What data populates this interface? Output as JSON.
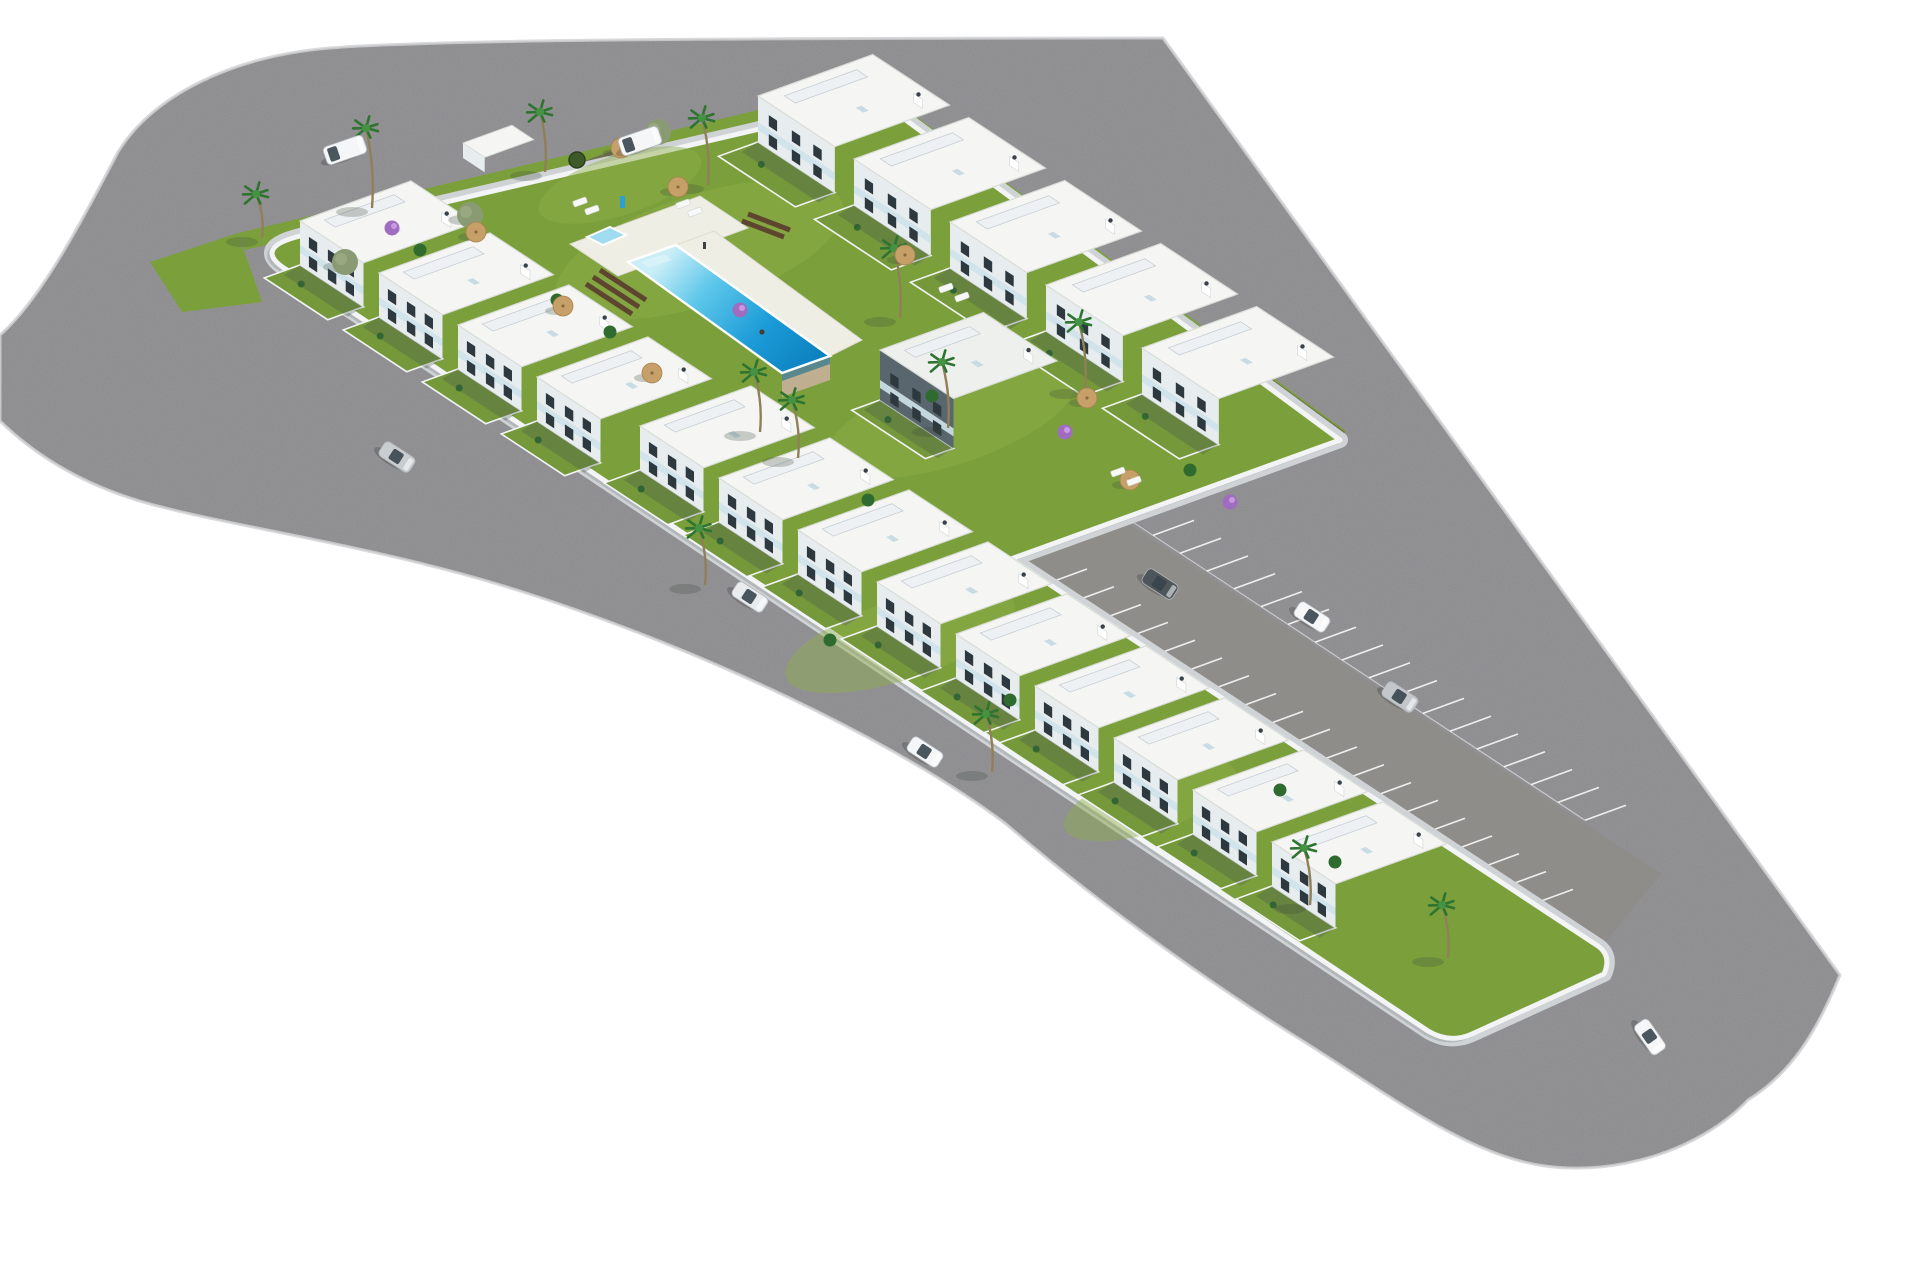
{
  "scene": {
    "width": 1920,
    "height": 1280,
    "background": "#ffffff",
    "label": "Aerial 3D architectural render of an L-shaped residential development: rows of white two-storey townhouses with roof terraces and external stairs, central communal garden with long turquoise pool, perimeter roads, parking bays and scattered cars, palms and parasols"
  },
  "axes": {
    "a": [
      0.94,
      -0.34
    ],
    "b": [
      0.835,
      0.55
    ]
  },
  "colors": {
    "asphalt": "#9e9ea1",
    "pave": "#8f8d8a",
    "curb": "#cfd3d6",
    "wall": "#f2f4f5",
    "wallShadow": "rgba(90,100,105,0.25)",
    "grass": "#7ba03b",
    "grassLight": "#8fae4a",
    "gardenGrass": "#74983a",
    "deck": "#efeee5",
    "water0": "#c9eef7",
    "water1": "#5ec7ea",
    "water2": "#1b9bd7",
    "water3": "#0c7fbe",
    "kidPool": "#9fdcef",
    "stone": "#bfae90",
    "overflow": "#46808e",
    "wood": "#5d4530",
    "roof": "#f5f6f3",
    "roofEdge": "#d9ddd8",
    "wallFace": "#e7ecef",
    "window": "#2e383f",
    "glass": "#cfe3ea",
    "stair": "#eef1f3",
    "slate": "#5a666e",
    "slateRoof": "#eef0ee",
    "bamboo": "#6e6e50",
    "palmFrond": "#2f7330",
    "palmFrond2": "#459243",
    "trunk": "#917f58",
    "olive": "#8a9b74",
    "bush": "#2f6b2e",
    "flower": "#a06cc0",
    "umbrella": "#c7a069",
    "lounger": "#f7f8f8",
    "parkLine": "rgba(255,255,255,0.85)",
    "shadow": "rgba(70,80,78,0.28)",
    "treeShadow": "rgba(60,72,60,0.25)",
    "carGlass": "#39454d"
  },
  "road": {
    "outline": "M 0,335 C 40,300 78,228 118,152 C 152,96 232,56 330,48 C 430,40 700,38 1163,38 L 1840,975 C 1816,1034 1790,1074 1748,1100 C 1700,1150 1618,1176 1545,1166 C 1468,1156 1388,1094 1298,1038 C 1192,972 1080,888 1006,824 C 898,742 700,648 520,591 C 378,546 238,528 150,504 C 88,487 38,458 0,421 Z"
  },
  "island": {
    "outline": "M 880,101 L 1340,440 L 1011,559 L 1598,946 Q 1612,956 1604,974 L 1472,1034 Q 1450,1044 1428,1031 L 300,277 Q 244,250 300,236 Z"
  },
  "verges": [
    {
      "pts": [
        [
          245,
          250
        ],
        [
          875,
          100
        ],
        [
          868,
          84
        ],
        [
          238,
          233
        ]
      ]
    },
    {
      "pts": [
        [
          150,
          262
        ],
        [
          238,
          233
        ],
        [
          262,
          302
        ],
        [
          182,
          312
        ]
      ]
    },
    {
      "pts": [
        [
          875,
          100
        ],
        [
          1340,
          440
        ],
        [
          1346,
          431
        ],
        [
          881,
          91
        ]
      ]
    }
  ],
  "bamboo": [
    {
      "pts": [
        [
          480,
          207
        ],
        [
          643,
          146
        ],
        [
          646,
          138
        ],
        [
          483,
          199
        ]
      ]
    },
    {
      "pts": [
        [
          1128,
          286
        ],
        [
          1340,
          440
        ],
        [
          1345,
          432
        ],
        [
          1133,
          278
        ]
      ]
    },
    {
      "pts": [
        [
          780,
          132
        ],
        [
          870,
          98
        ],
        [
          872,
          92
        ],
        [
          782,
          126
        ]
      ]
    }
  ],
  "parking": {
    "pave": [
      [
        1035,
        462
      ],
      [
        1661,
        874
      ],
      [
        1601,
        948
      ],
      [
        1014,
        560
      ]
    ],
    "rows": [
      {
        "start": [
          1072,
          482
        ],
        "step": [
          27,
          17.8
        ],
        "count": 20,
        "tick": [
          41,
          -15
        ]
      },
      {
        "start": [
          1046,
          584
        ],
        "step": [
          27,
          17.8
        ],
        "count": 19,
        "tick": [
          41,
          -15
        ]
      }
    ]
  },
  "lawnPatches": [
    {
      "c": [
        700,
        250
      ],
      "rx": 150,
      "ry": 55
    },
    {
      "c": [
        950,
        420
      ],
      "rx": 130,
      "ry": 45
    },
    {
      "c": [
        620,
        185
      ],
      "rx": 85,
      "ry": 30
    },
    {
      "c": [
        900,
        640
      ],
      "rx": 120,
      "ry": 40
    },
    {
      "c": [
        1150,
        800
      ],
      "rx": 90,
      "ry": 32
    }
  ],
  "rows": [
    {
      "name": "row-upper-right",
      "anchor": [
        758,
        142
      ],
      "step": [
        96,
        63
      ],
      "count": 5,
      "w": 92,
      "d": 122,
      "h": 46,
      "garden": 42
    },
    {
      "name": "building-special",
      "anchor": [
        880,
        400
      ],
      "step": [
        0,
        0
      ],
      "count": 1,
      "w": 88,
      "d": 110,
      "h": 50,
      "garden": 30,
      "wall": "slate",
      "roof": "slateRoof"
    },
    {
      "name": "row-upper-left",
      "anchor": [
        300,
        265
      ],
      "step": [
        79,
        52
      ],
      "count": 4,
      "w": 76,
      "d": 118,
      "h": 44,
      "garden": 38
    },
    {
      "name": "row-lower",
      "anchor": [
        640,
        470
      ],
      "step": [
        79,
        52
      ],
      "count": 9,
      "w": 76,
      "d": 118,
      "h": 44,
      "garden": 38
    }
  ],
  "storage": {
    "anchor": [
      463,
      158
    ],
    "w": 26,
    "d": 52,
    "h": 15
  },
  "pool": {
    "deck": [
      [
        570,
        244
      ],
      [
        700,
        196
      ],
      [
        748,
        228
      ],
      [
        618,
        276
      ]
    ],
    "deck2": [
      [
        676,
        245
      ],
      [
        714,
        231
      ],
      [
        862,
        340
      ],
      [
        830,
        356
      ]
    ],
    "main": [
      [
        628,
        262
      ],
      [
        676,
        245
      ],
      [
        830,
        356
      ],
      [
        782,
        373
      ]
    ],
    "kids": [
      [
        587,
        237
      ],
      [
        610,
        227
      ],
      [
        626,
        235
      ],
      [
        603,
        245
      ]
    ],
    "steps": [
      [
        640,
        262
      ],
      [
        664,
        254
      ],
      [
        672,
        260
      ],
      [
        648,
        268
      ]
    ],
    "stoneWall": [
      [
        782,
        373
      ],
      [
        830,
        356
      ],
      [
        830,
        380
      ],
      [
        782,
        397
      ]
    ],
    "overflowFace": [
      [
        782,
        373
      ],
      [
        830,
        356
      ],
      [
        830,
        364
      ],
      [
        782,
        381
      ]
    ],
    "woodBars": [
      [
        [
          600,
          270
        ],
        [
          646,
          300
        ]
      ],
      [
        [
          593,
          277
        ],
        [
          639,
          307
        ]
      ],
      [
        [
          586,
          284
        ],
        [
          632,
          314
        ]
      ],
      [
        [
          748,
          214
        ],
        [
          790,
          230
        ]
      ],
      [
        [
          742,
          221
        ],
        [
          784,
          237
        ]
      ]
    ],
    "shower": [
      620,
      196
    ],
    "swimmer": [
      762,
      332
    ],
    "person": [
      703,
      242
    ]
  },
  "palms": [
    {
      "r": [
        262,
        238
      ],
      "t": [
        256,
        194
      ]
    },
    {
      "r": [
        372,
        208
      ],
      "t": [
        366,
        128
      ]
    },
    {
      "r": [
        545,
        172
      ],
      "t": [
        540,
        112
      ]
    },
    {
      "r": [
        708,
        185
      ],
      "t": [
        702,
        118
      ]
    },
    {
      "r": [
        900,
        318
      ],
      "t": [
        894,
        248
      ]
    },
    {
      "r": [
        948,
        428
      ],
      "t": [
        942,
        362
      ]
    },
    {
      "r": [
        1085,
        390
      ],
      "t": [
        1079,
        322
      ]
    },
    {
      "r": [
        760,
        432
      ],
      "t": [
        754,
        372
      ]
    },
    {
      "r": [
        798,
        458
      ],
      "t": [
        792,
        400
      ]
    },
    {
      "r": [
        705,
        585
      ],
      "t": [
        699,
        528
      ]
    },
    {
      "r": [
        992,
        772
      ],
      "t": [
        986,
        714
      ]
    },
    {
      "r": [
        1310,
        905
      ],
      "t": [
        1304,
        848
      ]
    },
    {
      "r": [
        1448,
        958
      ],
      "t": [
        1442,
        905
      ]
    }
  ],
  "olives": [
    [
      345,
      262
    ],
    [
      658,
      132
    ],
    [
      470,
      215
    ]
  ],
  "bushes": [
    [
      420,
      250
    ],
    [
      610,
      332
    ],
    [
      932,
      396
    ],
    [
      1190,
      470
    ],
    [
      830,
      640
    ],
    [
      1010,
      700
    ],
    [
      1280,
      790
    ],
    [
      557,
      300
    ],
    [
      1335,
      862
    ],
    [
      868,
      500
    ]
  ],
  "flowers": [
    [
      392,
      228
    ],
    [
      1065,
      432
    ],
    [
      740,
      310
    ],
    [
      1230,
      502
    ]
  ],
  "umbrellas": [
    [
      476,
      232
    ],
    [
      563,
      306
    ],
    [
      652,
      373
    ],
    [
      678,
      187
    ],
    [
      905,
      255
    ],
    [
      1087,
      398
    ],
    [
      1130,
      480
    ],
    [
      621,
      148
    ]
  ],
  "loungers": [
    [
      580,
      202
    ],
    [
      592,
      210
    ],
    [
      683,
      204
    ],
    [
      695,
      212
    ],
    [
      946,
      288
    ],
    [
      962,
      297
    ],
    [
      1118,
      472
    ],
    [
      1134,
      481
    ]
  ],
  "trampoline": [
    577,
    160,
    8
  ],
  "cars": [
    {
      "x": 345,
      "y": 150,
      "rot": -19,
      "color": "#f4f6f7",
      "type": "van"
    },
    {
      "x": 640,
      "y": 141,
      "rot": -19,
      "color": "#f4f6f7",
      "type": "van"
    },
    {
      "x": 397,
      "y": 457,
      "rot": 33,
      "color": "#c9cdd0",
      "type": "car"
    },
    {
      "x": 750,
      "y": 597,
      "rot": 33,
      "color": "#e9ecee",
      "type": "car"
    },
    {
      "x": 925,
      "y": 752,
      "rot": 33,
      "color": "#f4f6f7",
      "type": "car"
    },
    {
      "x": 1312,
      "y": 617,
      "rot": 33,
      "color": "#f4f6f7",
      "type": "car"
    },
    {
      "x": 1400,
      "y": 697,
      "rot": 33,
      "color": "#c3c7cb",
      "type": "car"
    },
    {
      "x": 1160,
      "y": 584,
      "rot": 33,
      "color": "#4e565c",
      "type": "car"
    },
    {
      "x": 1650,
      "y": 1037,
      "rot": 55,
      "color": "#f4f6f7",
      "type": "car"
    }
  ]
}
